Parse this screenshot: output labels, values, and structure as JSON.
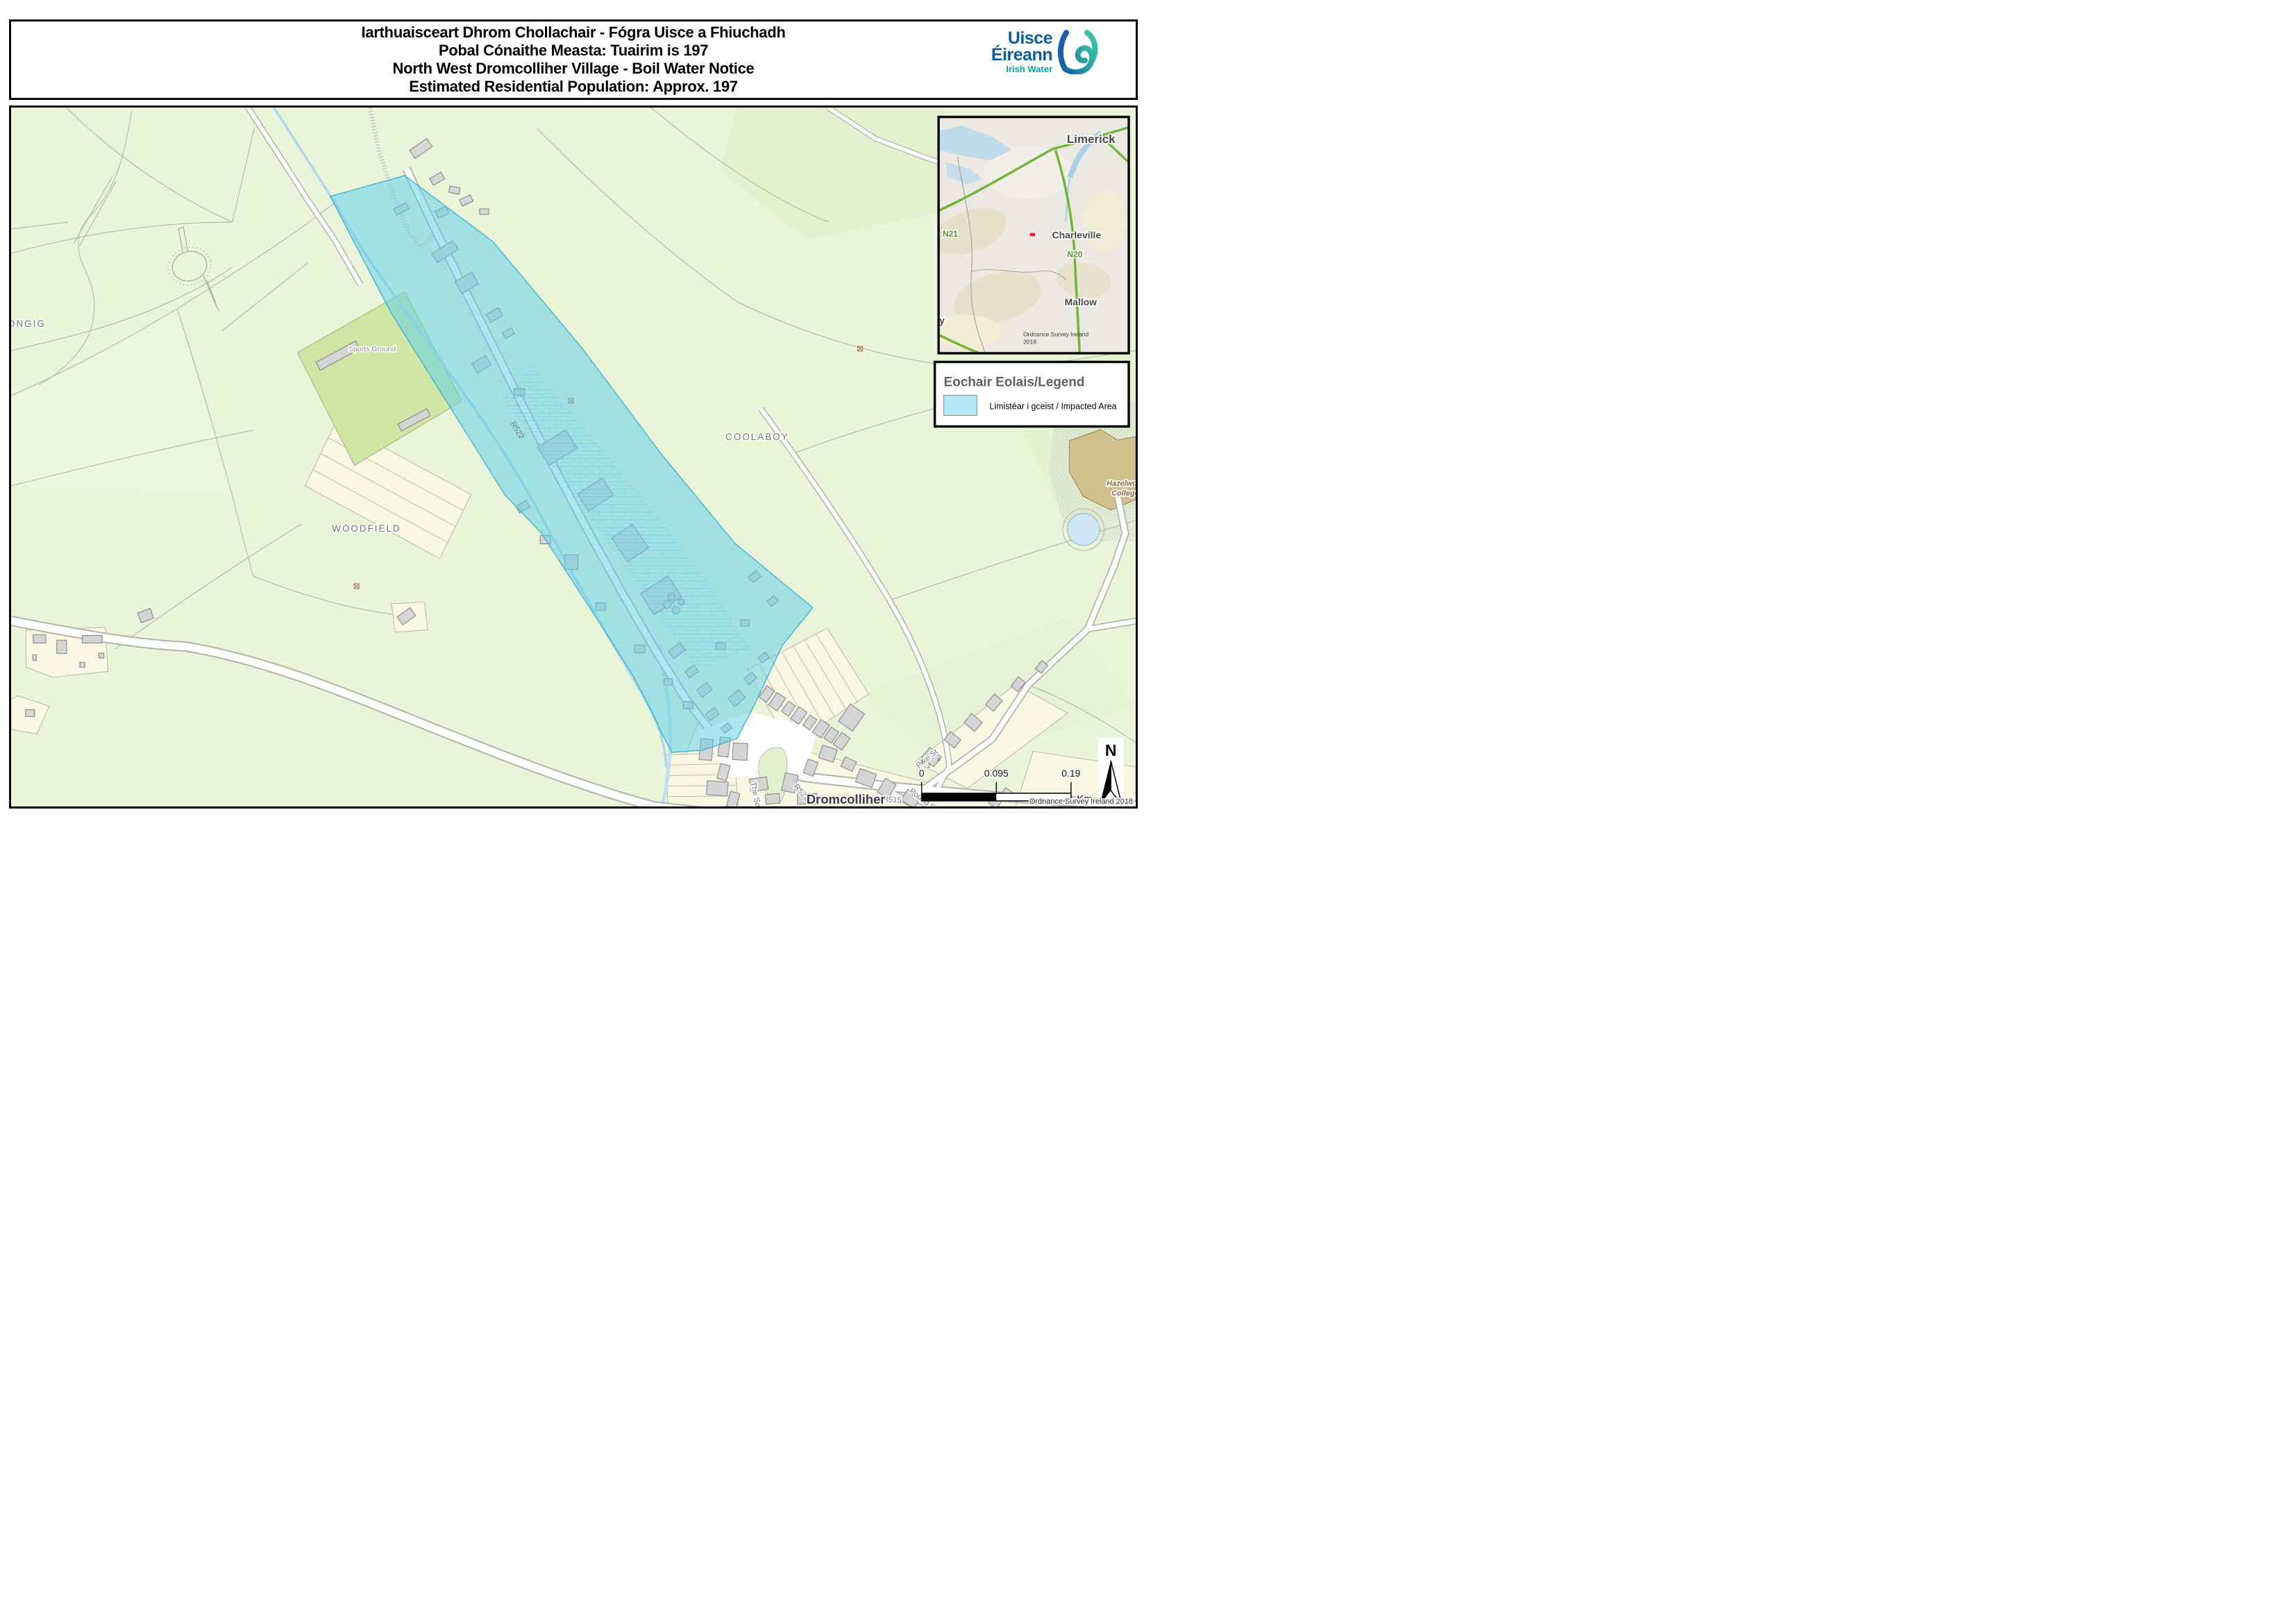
{
  "header": {
    "title_lines": [
      "Iarthuaisceart Dhrom Chollachair  - Fógra Uisce a Fhiuchadh",
      "Pobal Cónaithe Measta: Tuairim is 197",
      "North West Dromcolliher Village - Boil Water Notice",
      "Estimated Residential Population: Approx. 197"
    ]
  },
  "logo": {
    "name_line1": "Uisce",
    "name_line2": "Éireann",
    "subtitle": "Irish Water"
  },
  "map": {
    "labels": {
      "townland_left": "ONGIG",
      "woodfield": "WOODFIELD",
      "coolaboy": "COOLABOY",
      "sports_ground": "Sports Ground",
      "r522_main": "R522",
      "r522_village": "R522",
      "the_sq": "The Sq",
      "r515": "R515",
      "pound_st": "Pound St",
      "pike_st": "Pike St",
      "village": "Dromcolliher",
      "college_line1": "Hazelwood",
      "college_line2": "College",
      "house_numbers": [
        "1",
        "2",
        "4"
      ]
    },
    "attribution": "Ordnance Survey Ireland 2018"
  },
  "inset": {
    "labels": {
      "limerick": "Limerick",
      "charleville": "Charleville",
      "mallow": "Mallow",
      "n21": "N21",
      "n20": "N20",
      "edge_partial": "y"
    },
    "attribution_line1": "Ordnance Survey Ireland",
    "attribution_line2": "2018"
  },
  "legend": {
    "title": "Eochair Eolais/Legend",
    "impacted_label": "Limistéar i gceist / Impacted Area"
  },
  "scale_bar": {
    "tick0": "0",
    "tick1": "0.095",
    "tick2": "0.19",
    "unit": "Km"
  },
  "north_arrow": {
    "label": "N"
  },
  "colors": {
    "impacted_fill": "#62cfe8",
    "impacted_border": "#3cb4d6",
    "legend_swatch": "#b5e7f7",
    "brand_blue": "#0d5e9e",
    "brand_teal": "#00a79d",
    "map_green": "#e9f4d9",
    "parcel_cream": "#faf7e3",
    "building_gray": "#d5d5d5",
    "road_green": "#72b637",
    "marker_red": "#e8262a"
  }
}
